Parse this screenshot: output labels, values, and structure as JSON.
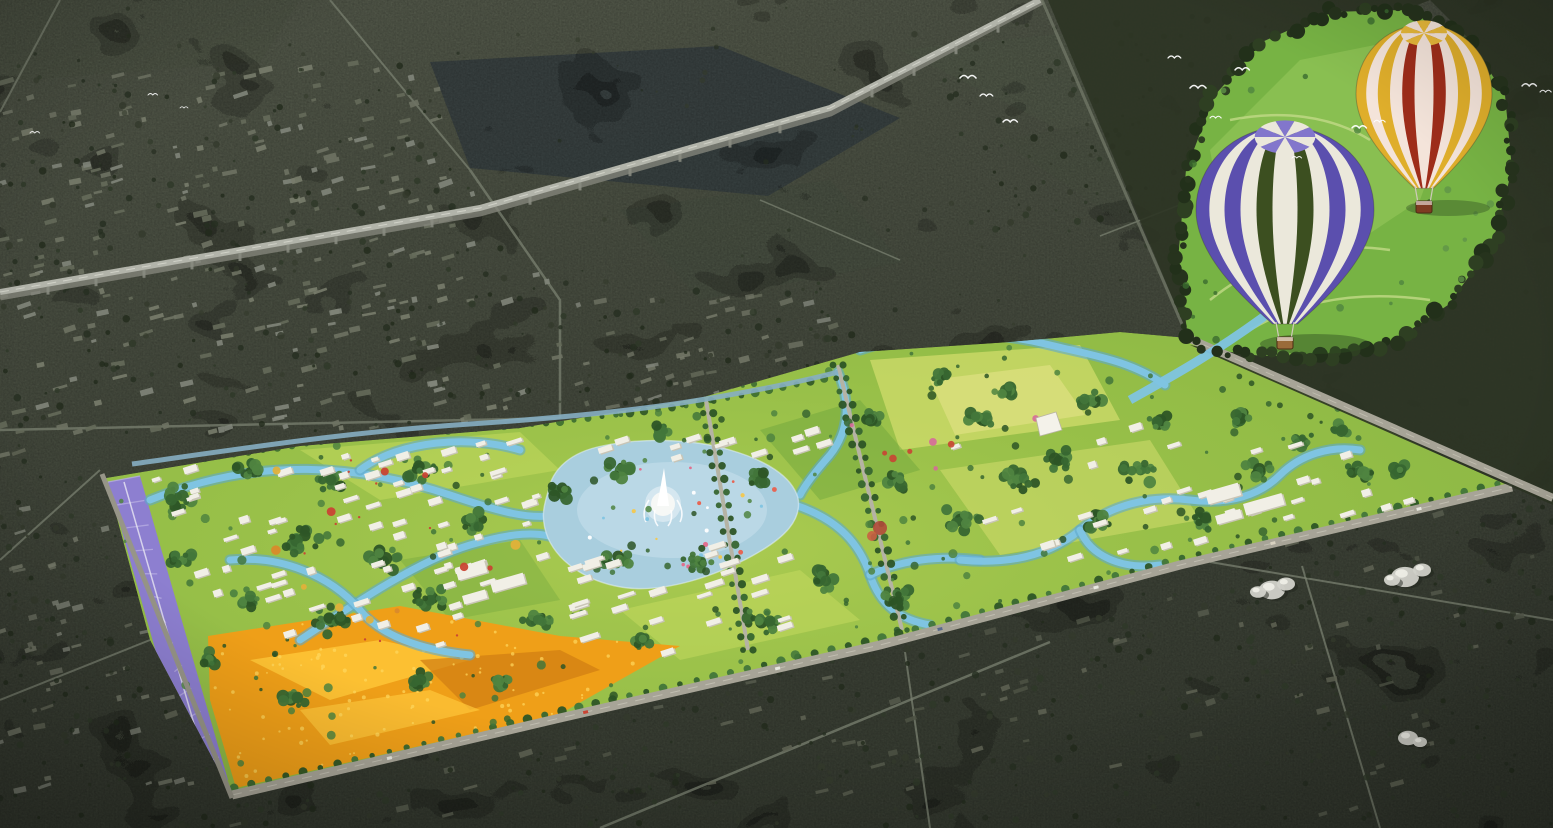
{
  "scene": {
    "palette": {
      "surround_top": "#5d6353",
      "surround_base": "#4c5244",
      "surround_deep": "#3e4438",
      "city_block": "#6e7263",
      "dark_field": "#3d4748",
      "road": "#798070",
      "boundary_road": "#a7a497",
      "expressway": "#b2b4aa",
      "canal": "#86aec2",
      "park_green": "#8fba45",
      "meadow_light": "#c8dc5f",
      "meadow_deep": "#6da43c",
      "field_yellow": "#d8e070",
      "forest_dark": "#2c3424",
      "tree_green": "#376630",
      "lake": "#a9cede",
      "lake_light": "#c6dfeb",
      "river": "#7fc4e2",
      "lavender": "#8d7fd0",
      "lavender_light": "#b7ade2",
      "sunflower": "#ef9f18",
      "sunflower_light": "#ffc83a",
      "building_white": "#f1efe6",
      "building_shade": "#c9c5b6",
      "heart_green": "#77b344",
      "heart_light": "#9ccb5e",
      "dome_white": "#d2d2ca",
      "accent_red": "#c94434",
      "accent_orange": "#d98a2b",
      "fountain_white": "#f6f8f6",
      "bird_white": "#ffffff"
    },
    "balloons": [
      {
        "name": "purple-white-green-balloon",
        "stripes": [
          "#5b4fae",
          "#ebe8db",
          "#5b4fae",
          "#ebe8db",
          "#3c4f20",
          "#ebe8db"
        ],
        "crown": "#8276cc",
        "basket": "#9a6b3a"
      },
      {
        "name": "yellow-red-cream-balloon",
        "stripes": [
          "#dfae2b",
          "#f4e4da",
          "#dfae2b",
          "#f4e4da",
          "#9e2d1a",
          "#f4e4da"
        ],
        "crown": "#e8b93a",
        "basket": "#7e3b22"
      }
    ]
  }
}
